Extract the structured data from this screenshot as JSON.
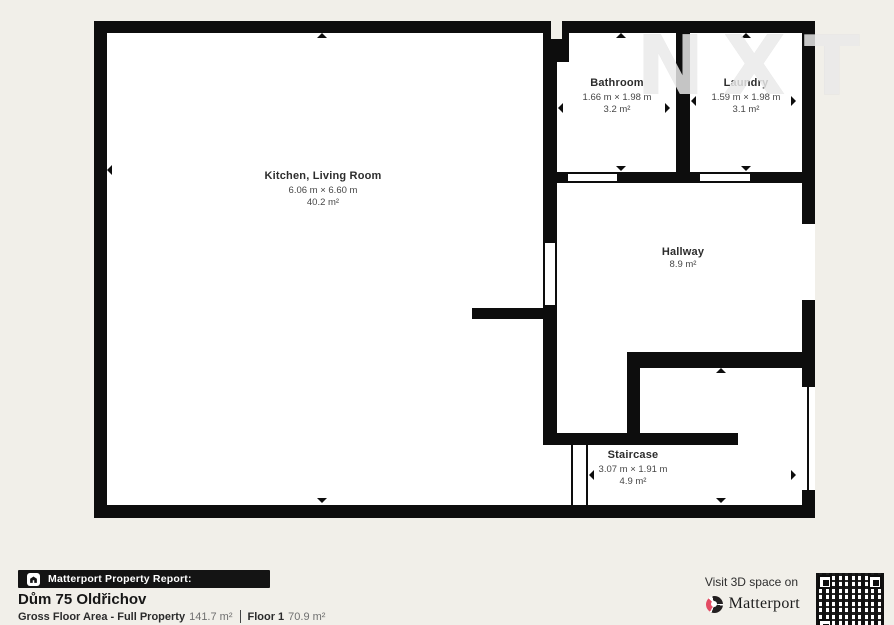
{
  "watermark": {
    "text": "NXT"
  },
  "colors": {
    "background": "#f1efe9",
    "wall": "#0d0d0d",
    "matterport_red": "#e34b63"
  },
  "floorplan": {
    "rooms": [
      {
        "id": "kitchen",
        "name": "Kitchen, Living Room",
        "dimensions": "6.06 m × 6.60 m",
        "area": "40.2 m²"
      },
      {
        "id": "bathroom",
        "name": "Bathroom",
        "dimensions": "1.66 m × 1.98 m",
        "area": "3.2 m²"
      },
      {
        "id": "laundry",
        "name": "Laundry",
        "dimensions": "1.59 m × 1.98 m",
        "area": "3.1 m²"
      },
      {
        "id": "hallway",
        "name": "Hallway",
        "dimensions": "",
        "area": "8.9 m²"
      },
      {
        "id": "staircase",
        "name": "Staircase",
        "dimensions": "3.07 m × 1.91 m",
        "area": "4.9 m²"
      }
    ]
  },
  "report": {
    "bar_label": "Matterport Property Report:",
    "title": "Dům 75 Oldřichov",
    "gross_label": "Gross Floor Area - Full Property",
    "gross_value": "141.7 m²",
    "floor_label": "Floor 1",
    "floor_value": "70.9 m²"
  },
  "visit": {
    "line": "Visit 3D space on",
    "brand": "Matterport"
  }
}
